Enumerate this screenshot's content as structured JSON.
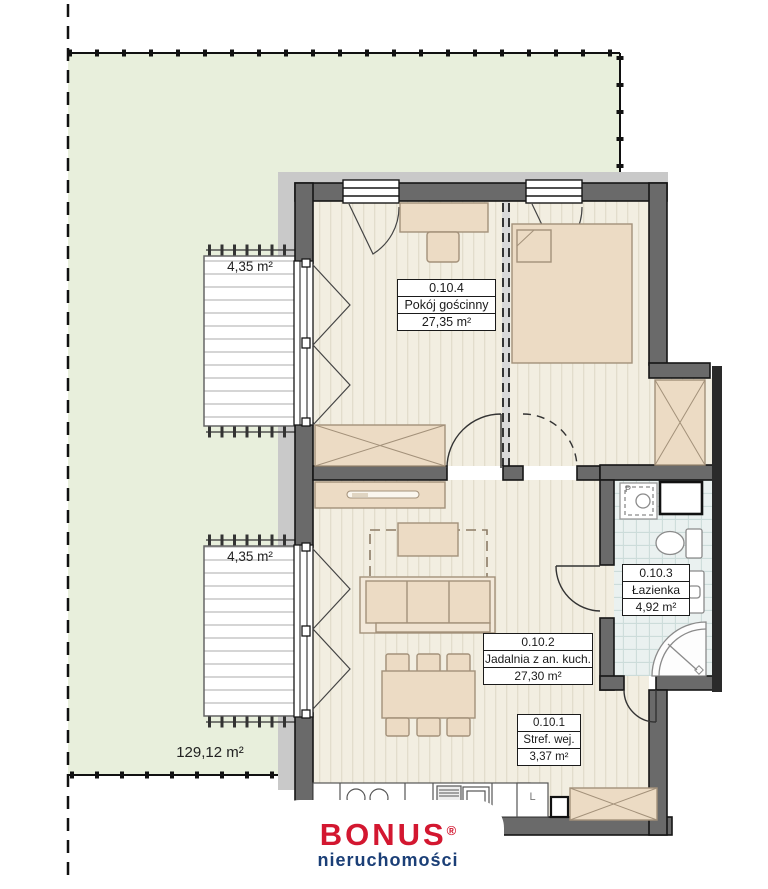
{
  "plan": {
    "rooms": [
      {
        "id": "0.10.4",
        "name": "Pokój gościnny",
        "area": "27,35 m²"
      },
      {
        "id": "0.10.2",
        "name": "Jadalnia z an. kuch.",
        "area": "27,30 m²"
      },
      {
        "id": "0.10.3",
        "name": "Łazienka",
        "area": "4,92 m²"
      },
      {
        "id": "0.10.1",
        "name": "Stref. wej.",
        "area": "3,37 m²"
      }
    ],
    "terraces": [
      {
        "area": "4,35 m²"
      },
      {
        "area": "4,35 m²"
      }
    ],
    "garden": {
      "area": "129,12 m²"
    },
    "appliances": {
      "fridge": "L",
      "washer": "P"
    }
  },
  "branding": {
    "brand": "BONUS",
    "registered": "®",
    "subtitle": "nieruchomości",
    "brand_color": "#d31730",
    "subtitle_color": "#1b3f77"
  },
  "colors": {
    "garden": "#e8efdc",
    "path": "#c9c9c9",
    "wall": "#6a6a6a",
    "floor": "#f2eee1",
    "tile": "#eaf1f0",
    "furniture": "#ecdbc4",
    "deck": "#ffffff"
  }
}
